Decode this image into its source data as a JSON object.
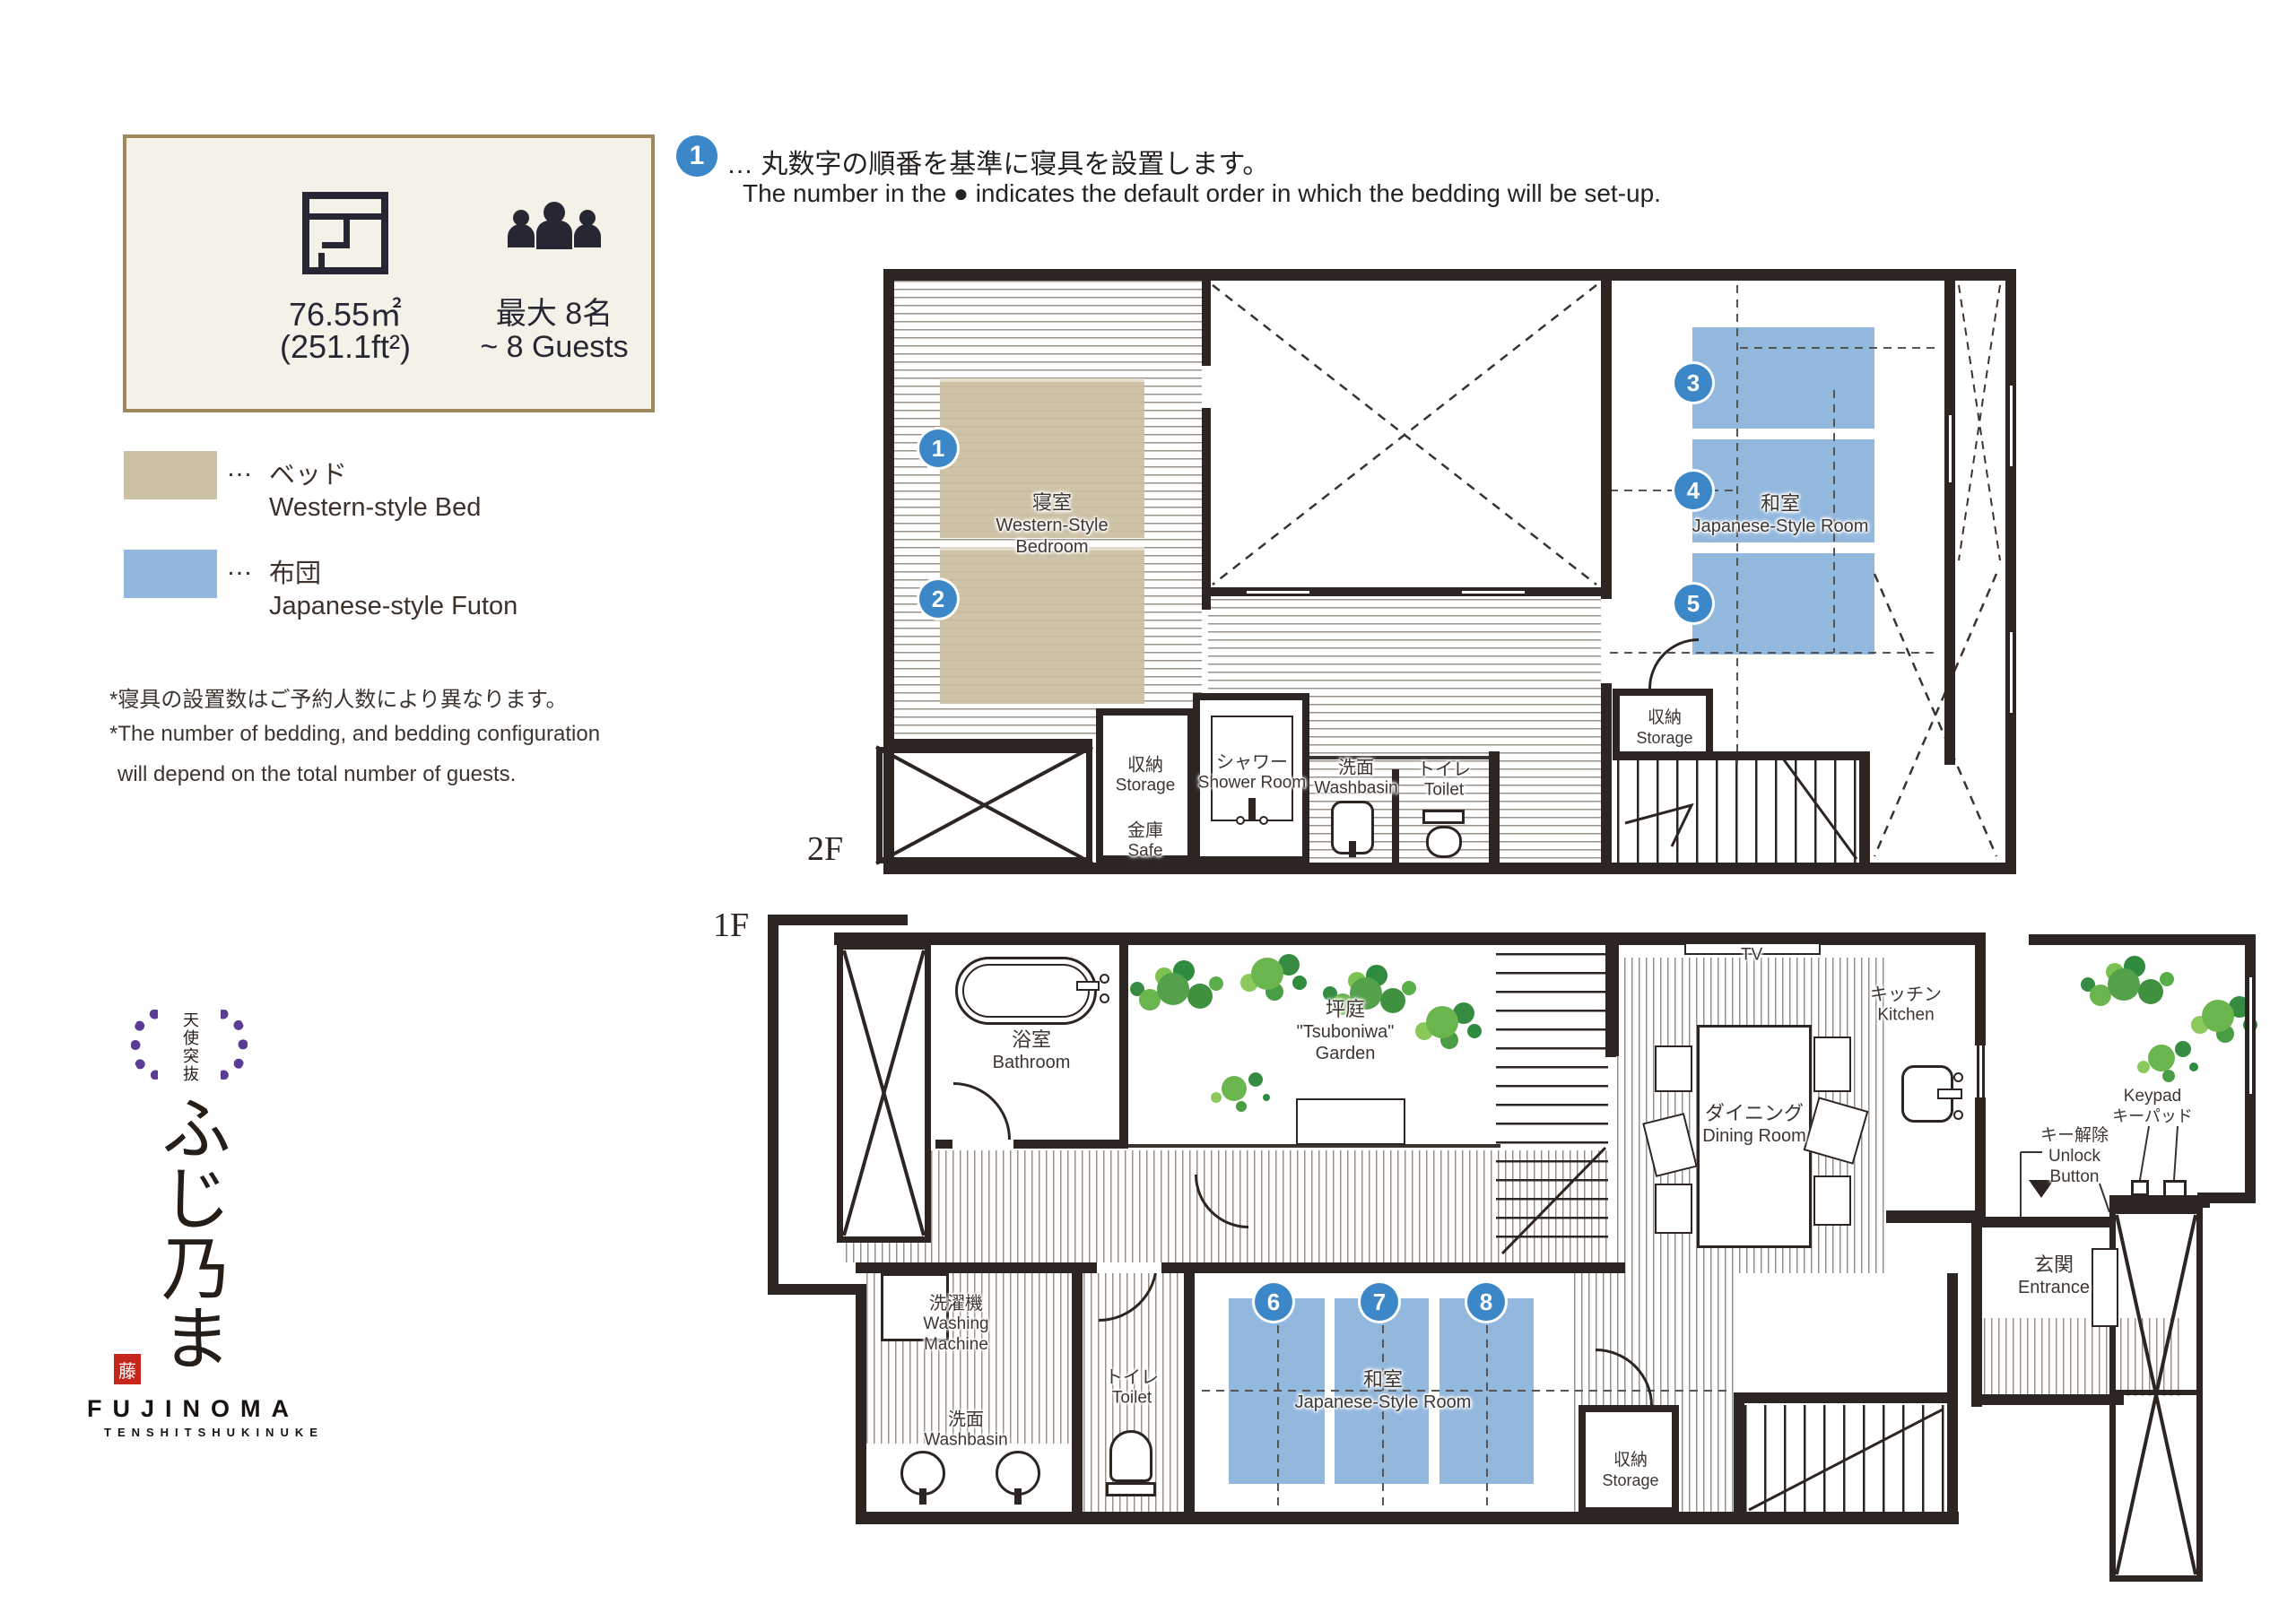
{
  "info_box": {
    "area_m2": "76.55㎡",
    "area_ft": "(251.1ft²)",
    "guests_jp": "最大 8名",
    "guests_en": "~ 8 Guests"
  },
  "legend": {
    "bed": {
      "dots": "…",
      "jp": "ベッド",
      "en": "Western-style Bed",
      "color": "#cbc0a3"
    },
    "futon": {
      "dots": "…",
      "jp": "布団",
      "en": "Japanese-style Futon",
      "color": "#92b7dc"
    }
  },
  "notes": {
    "line1": "*寝具の設置数はご予約人数により異なります。",
    "line2": "*The number of bedding, and bedding configuration",
    "line3": "will depend on the total number of guests."
  },
  "header_note": {
    "badge": "1",
    "jp": "… 丸数字の順番を基準に寝具を設置します。",
    "en": "The number in the ● indicates the default order in which the bedding will be set-up."
  },
  "floor2": {
    "label": "2F",
    "badges": [
      "1",
      "2",
      "3",
      "4",
      "5"
    ],
    "rooms": {
      "bedroom": {
        "jp": "寝室",
        "en1": "Western-Style",
        "en2": "Bedroom"
      },
      "japanese_room": {
        "jp": "和室",
        "en": "Japanese-Style Room"
      },
      "storage": {
        "jp": "収納",
        "en": "Storage"
      },
      "safe": {
        "jp": "金庫",
        "en": "Safe"
      },
      "shower": {
        "jp": "シャワー",
        "en": "Shower Room"
      },
      "washbasin": {
        "jp": "洗面",
        "en": "Washbasin"
      },
      "toilet": {
        "jp": "トイレ",
        "en": "Toilet"
      },
      "storage2": {
        "jp": "収納",
        "en": "Storage"
      }
    }
  },
  "floor1": {
    "label": "1F",
    "badges": [
      "6",
      "7",
      "8"
    ],
    "rooms": {
      "bathroom": {
        "jp": "浴室",
        "en": "Bathroom"
      },
      "garden": {
        "jp": "坪庭",
        "en1": "\"Tsuboniwa\"",
        "en2": "Garden"
      },
      "tv": "TV",
      "dining": {
        "jp": "ダイニング",
        "en": "Dining Room"
      },
      "kitchen": {
        "jp": "キッチン",
        "en": "Kitchen"
      },
      "keypad": {
        "en": "Keypad",
        "jp": "キーパッド"
      },
      "unlock": {
        "jp": "キー解除",
        "en1": "Unlock",
        "en2": "Button"
      },
      "entrance": {
        "jp": "玄関",
        "en": "Entrance"
      },
      "washing_machine": {
        "jp": "洗濯機",
        "en1": "Washing",
        "en2": "Machine"
      },
      "washbasin": {
        "jp": "洗面",
        "en": "Washbasin"
      },
      "toilet": {
        "jp": "トイレ",
        "en": "Toilet"
      },
      "japanese_room": {
        "jp": "和室",
        "en": "Japanese-Style Room"
      },
      "storage": {
        "jp": "収納",
        "en": "Storage"
      }
    }
  },
  "logo": {
    "mon": "天使突抜",
    "name": "ふじ乃ま",
    "seal": "藤",
    "brand": "FUJINOMA",
    "sub": "TENSHITSHUKINUKE"
  },
  "colors": {
    "bed": "#cbc0a3",
    "futon": "#92b7dc",
    "badge": "#3b87c8",
    "wall": "#2d2521",
    "accent_border": "#a1885c",
    "logo_purple": "#5a3c94",
    "seal_red": "#c5271d"
  }
}
